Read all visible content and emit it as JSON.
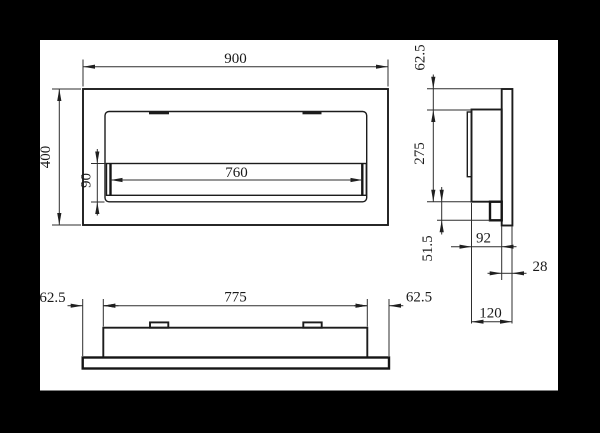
{
  "drawing": {
    "colors": {
      "outer_background": "#000000",
      "sheet_background": "#ffffff",
      "line_color": "#1c1c1c"
    },
    "front_view": {
      "overall_width": "900",
      "overall_height": "400",
      "burner_width": "760",
      "burner_height": "90"
    },
    "side_view": {
      "top_inset": "62.5",
      "body_height": "275",
      "bottom_inset": "51.5",
      "body_depth": "92",
      "flange_depth": "28",
      "total_depth": "120"
    },
    "bottom_view": {
      "left_inset": "62.5",
      "inner_width": "775",
      "right_inset": "62.5"
    }
  }
}
